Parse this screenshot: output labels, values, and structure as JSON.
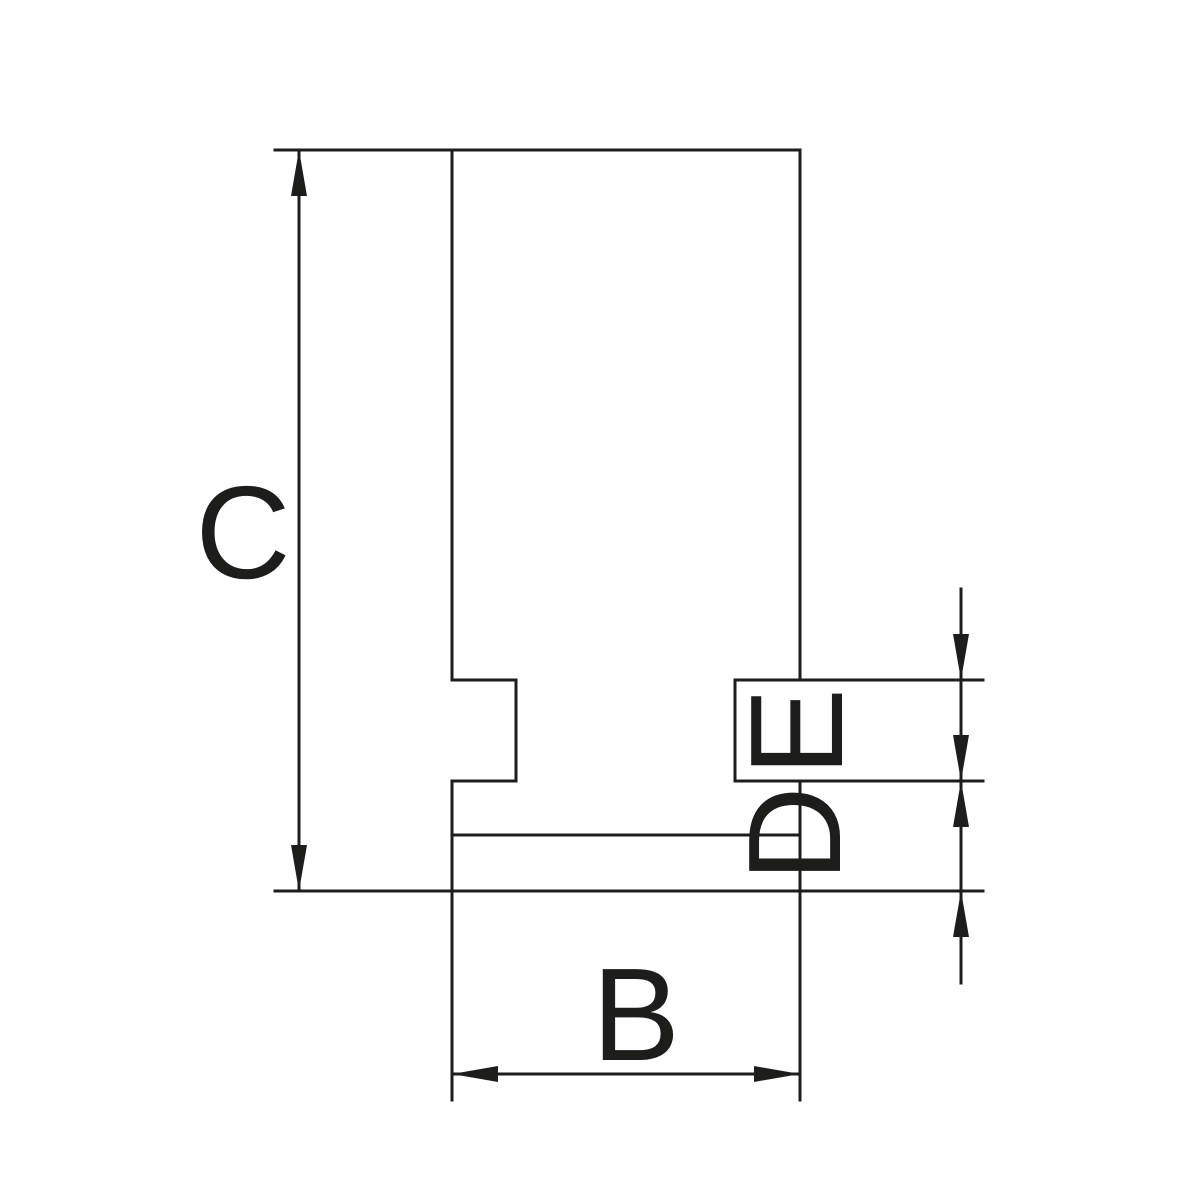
{
  "drawing": {
    "type": "technical-dimension-drawing",
    "labels": {
      "c": "C",
      "b": "B",
      "e": "E",
      "d": "D"
    },
    "colors": {
      "line": "#1d1d1b",
      "background": "#ffffff"
    }
  }
}
